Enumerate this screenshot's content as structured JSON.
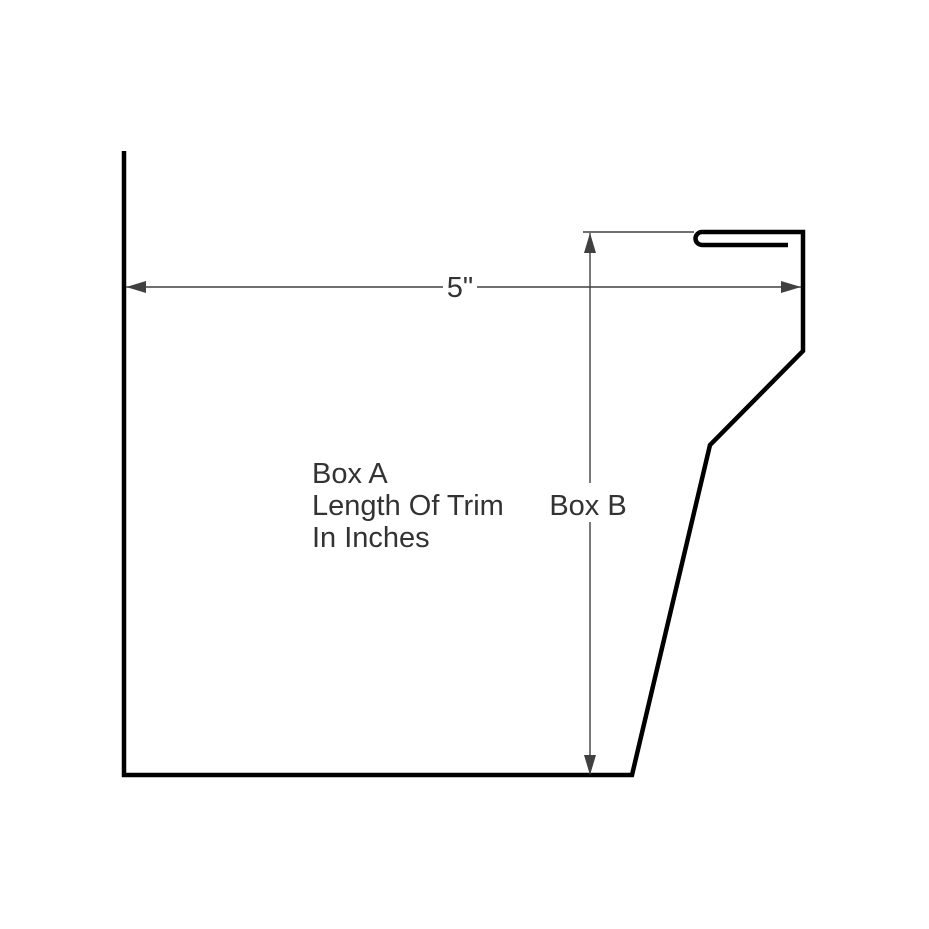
{
  "diagram": {
    "labels": {
      "width_dimension": "5\"",
      "box_a_line1": "Box A",
      "box_a_line2": "Length Of Trim",
      "box_a_line3": "In Inches",
      "box_b": "Box B"
    },
    "colors": {
      "background": "#ffffff",
      "profile_stroke": "#000000",
      "dimension_stroke": "#404040",
      "text": "#333333"
    }
  }
}
